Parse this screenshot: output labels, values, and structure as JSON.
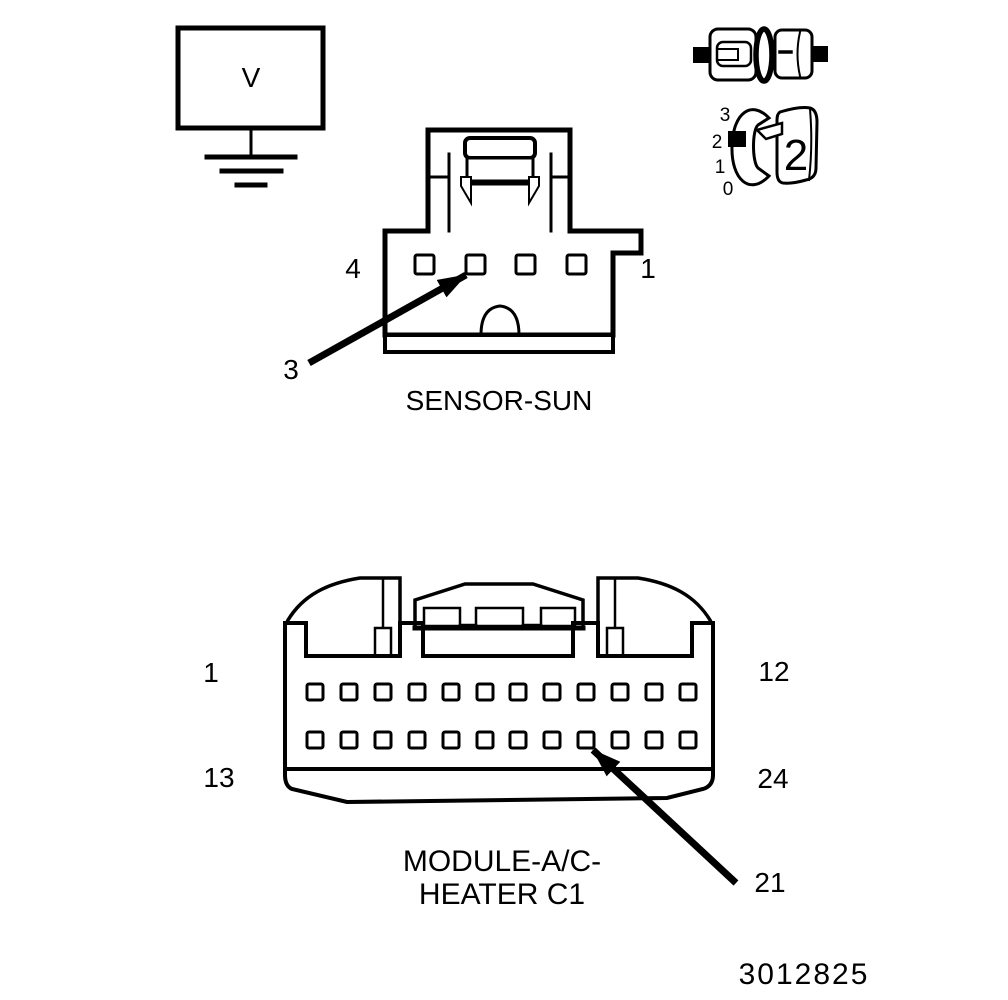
{
  "colors": {
    "line": "#000000",
    "background": "#ffffff"
  },
  "meter": {
    "label": "V"
  },
  "gauge_icon": {
    "scale": [
      "3",
      "2",
      "1",
      "0"
    ],
    "position": "2"
  },
  "sensor": {
    "caption": "SENSOR-SUN",
    "pin_count": 4,
    "label_left": "4",
    "label_right": "1",
    "callout_pin": "3"
  },
  "module": {
    "caption_line1": "MODULE-A/C-",
    "caption_line2": "HEATER C1",
    "pins_per_row": 12,
    "rows": 2,
    "label_top_left": "1",
    "label_top_right": "12",
    "label_bottom_left": "13",
    "label_bottom_right": "24",
    "callout_pin": "21"
  },
  "part_number": "3012825"
}
